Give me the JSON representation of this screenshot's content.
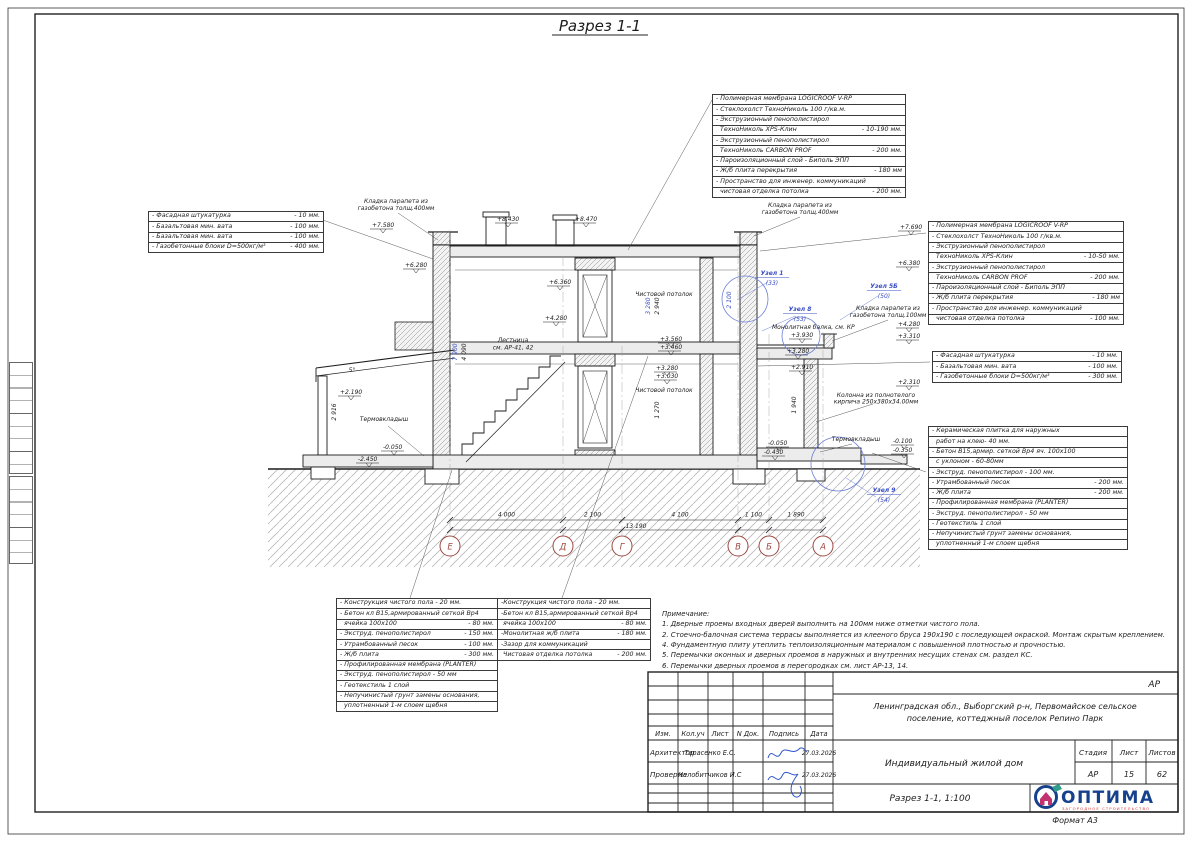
{
  "sheet": {
    "title": "Разрез 1-1",
    "format_label": "Формат А3"
  },
  "colors": {
    "line": "#1c1c1c",
    "blue_dim": "#3a4fc4",
    "axis_red": "#9c4a41",
    "logo_navy": "#16418c",
    "logo_red": "#d93a3a",
    "logo_teal": "#2e9e8a",
    "logo_magenta": "#c2326e"
  },
  "blocks": {
    "roof_top": {
      "lines": [
        {
          "t": "- Полимерная мембрана LOGICROOF V-RP",
          "v": ""
        },
        {
          "t": "- Стеклохолст ТехноНиколь 100 г/кв.м.",
          "v": ""
        },
        {
          "t": "- Экструзионный пенополистирол",
          "v": ""
        },
        {
          "t": "  ТехноНиколь XPS-Клин",
          "v": "- 10-190 мм."
        },
        {
          "t": "- Экструзионный пенополистирол",
          "v": ""
        },
        {
          "t": "  ТехноНиколь CARBON PROF",
          "v": "- 200 мм."
        },
        {
          "t": "- Пароизоляционный слой - Биполь ЭПП",
          "v": ""
        },
        {
          "t": "- Ж/б плита перекрытия",
          "v": "- 180 мм"
        },
        {
          "t": "- Пространство для инженер. коммуникаций",
          "v": ""
        },
        {
          "t": "  чистовая отделка потолка",
          "v": "- 200 мм."
        }
      ]
    },
    "roof_right": {
      "lines": [
        {
          "t": "- Полимерная мембрана LOGICROOF V-RP",
          "v": ""
        },
        {
          "t": "- Стеклохолст ТехноНиколь 100 г/кв.м.",
          "v": ""
        },
        {
          "t": "- Экструзионный пенополистирол",
          "v": ""
        },
        {
          "t": "  ТехноНиколь XPS-Клин",
          "v": "- 10-50 мм."
        },
        {
          "t": "- Экструзионный пенополистирол",
          "v": ""
        },
        {
          "t": "  ТехноНиколь CARBON PROF",
          "v": "- 200 мм."
        },
        {
          "t": "- Пароизоляционный слой - Биполь ЭПП",
          "v": ""
        },
        {
          "t": "- Ж/б плита перекрытия",
          "v": "- 180 мм"
        },
        {
          "t": "- Пространство для инженер. коммуникаций",
          "v": ""
        },
        {
          "t": "  чистовая отделка потолка",
          "v": "- 100 мм."
        }
      ]
    },
    "wall_left": {
      "lines": [
        {
          "t": "- Фасадная штукатурка",
          "v": "- 10 мм."
        },
        {
          "t": "- Базальтовая мин. вата",
          "v": "- 100 мм."
        },
        {
          "t": "- Базальтовая мин. вата",
          "v": "- 100 мм."
        },
        {
          "t": "- Газобетонные блоки D=500кг/м³",
          "v": "- 400 мм."
        }
      ]
    },
    "wall_right": {
      "lines": [
        {
          "t": "- Фасадная штукатурка",
          "v": "- 10 мм."
        },
        {
          "t": "- Базальтовая мин. вата",
          "v": "- 100 мм."
        },
        {
          "t": "- Газобетонные блоки D=500кг/м³",
          "v": "- 300 мм."
        }
      ]
    },
    "terrace_right": {
      "lines": [
        {
          "t": "- Керамическая плитка для наружных",
          "v": ""
        },
        {
          "t": "  работ на клею- 40 мм.",
          "v": ""
        },
        {
          "t": "- Бетон В15,армир. сеткой Вр4 яч. 100х100",
          "v": ""
        },
        {
          "t": "  с уклоном - 60-80мм",
          "v": ""
        },
        {
          "t": "- Экструд. пенополистирол - 100 мм.",
          "v": ""
        },
        {
          "t": "- Утрамбованный песок",
          "v": "- 200 мм."
        },
        {
          "t": "- Ж/б плита",
          "v": "- 200 мм."
        },
        {
          "t": "- Профилированная мембрана (PLANTER)",
          "v": ""
        },
        {
          "t": "- Экструд. пенополистирол - 50 мм",
          "v": ""
        },
        {
          "t": "- Геотекстиль 1 слой",
          "v": ""
        },
        {
          "t": "- Непучинистый грунт замены основания,",
          "v": ""
        },
        {
          "t": "  уплотненный 1-м слоем щебня",
          "v": ""
        }
      ]
    },
    "floor_ground": {
      "lines": [
        {
          "t": "- Конструкция чистого пола - 20 мм.",
          "v": ""
        },
        {
          "t": "- Бетон кл В15,армированный сеткой Вр4",
          "v": ""
        },
        {
          "t": "  ячейка 100х100",
          "v": "- 80 мм."
        },
        {
          "t": "- Экструд. пенополистирол",
          "v": "- 150 мм."
        },
        {
          "t": "- Утрамбованный песок",
          "v": "- 100 мм."
        },
        {
          "t": "- Ж/б плита",
          "v": "- 300 мм."
        },
        {
          "t": "- Профилированная мембрана (PLANTER)",
          "v": ""
        },
        {
          "t": "- Экструд. пенополистирол - 50 мм",
          "v": ""
        },
        {
          "t": "- Геотекстиль 1 слой",
          "v": ""
        },
        {
          "t": "- Непучинистый грунт замены основания,",
          "v": ""
        },
        {
          "t": "  уплотненный 1-м слоем щебня",
          "v": ""
        }
      ]
    },
    "floor_inter": {
      "lines": [
        {
          "t": "-Конструкция чистого пола - 20 мм.",
          "v": ""
        },
        {
          "t": "-Бетон кл В15,армированный сеткой Вр4",
          "v": ""
        },
        {
          "t": " ячейка 100х100",
          "v": "- 80 мм."
        },
        {
          "t": "-Монолитная ж/б плита",
          "v": "- 180 мм."
        },
        {
          "t": "-Зазор для коммуникаций",
          "v": ""
        },
        {
          "t": " Чистовая отделка потолка",
          "v": "- 200 мм."
        }
      ]
    }
  },
  "notes": {
    "title": "Примечание:",
    "items": [
      "1. Дверные проемы входных дверей выполнить на 100мм ниже отметки чистого пола.",
      "2. Стоечно-балочная система террасы выполняется из клееного бруса 190х190 с последующей окраской. Монтаж скрытым креплением.",
      "4. Фундаментную плиту утеплить теплоизоляционным материалом с повышенной плотностью и прочностью.",
      "5. Перемычки оконных и дверных проемов в наружных и внутренних несущих стенах см. раздел КС.",
      "6. Перемычки дверных проемов в перегородках см. лист АР-13, 14."
    ]
  },
  "drawing": {
    "elevations": [
      {
        "v": "+7.580",
        "x": 372,
        "y": 227
      },
      {
        "v": "+8.430",
        "x": 497,
        "y": 221
      },
      {
        "v": "+8.470",
        "x": 575,
        "y": 221
      },
      {
        "v": "+7.690",
        "x": 900,
        "y": 229
      },
      {
        "v": "+6.280",
        "x": 405,
        "y": 267
      },
      {
        "v": "+6.380",
        "x": 898,
        "y": 265
      },
      {
        "v": "+6.360",
        "x": 549,
        "y": 284
      },
      {
        "v": "+4.280",
        "x": 545,
        "y": 320
      },
      {
        "v": "+4.280",
        "x": 898,
        "y": 326
      },
      {
        "v": "+3.930",
        "x": 791,
        "y": 337
      },
      {
        "v": "+3.310",
        "x": 898,
        "y": 338
      },
      {
        "v": "+3.280",
        "x": 787,
        "y": 353
      },
      {
        "v": "+2.910",
        "x": 791,
        "y": 369
      },
      {
        "v": "+3.560",
        "x": 660,
        "y": 341
      },
      {
        "v": "+3.460",
        "x": 660,
        "y": 349
      },
      {
        "v": "+3.280",
        "x": 656,
        "y": 370
      },
      {
        "v": "+3.030",
        "x": 656,
        "y": 378
      },
      {
        "v": "+2.310",
        "x": 898,
        "y": 384
      },
      {
        "v": "+2.190",
        "x": 340,
        "y": 394
      },
      {
        "v": "-0.050",
        "x": 383,
        "y": 449
      },
      {
        "v": "-2.450",
        "x": 358,
        "y": 461
      },
      {
        "v": "-0.050",
        "x": 768,
        "y": 445
      },
      {
        "v": "-0.450",
        "x": 764,
        "y": 454
      },
      {
        "v": "-0.100",
        "x": 893,
        "y": 443
      },
      {
        "v": "-0.350",
        "x": 893,
        "y": 452
      }
    ],
    "dims_small": [
      {
        "v": "7 900",
        "x": 457,
        "y": 352,
        "b": true
      },
      {
        "v": "4 090",
        "x": 466,
        "y": 352
      },
      {
        "v": "2 916",
        "x": 336,
        "y": 412
      },
      {
        "v": "3 280",
        "x": 650,
        "y": 306,
        "b": true
      },
      {
        "v": "2 940",
        "x": 659,
        "y": 306
      },
      {
        "v": "2 100",
        "x": 731,
        "y": 300,
        "b": true
      },
      {
        "v": "1 270",
        "x": 659,
        "y": 410
      },
      {
        "v": "1 940",
        "x": 796,
        "y": 405
      }
    ],
    "labels": [
      {
        "t": "Кладка парапета из\nгазобетона толщ.400мм",
        "x": 396,
        "y": 203,
        "s": 5.5
      },
      {
        "t": "Кладка парапета из\nгазобетона толщ.400мм",
        "x": 800,
        "y": 207,
        "s": 5.5
      },
      {
        "t": "Кладка парапета из\nгазобетона толщ.100мм",
        "x": 888,
        "y": 310,
        "s": 5.5
      },
      {
        "t": "Монолитная балка, см. КР",
        "x": 772,
        "y": 329,
        "a": "start",
        "s": 5.5
      },
      {
        "t": "Лестница\nсм. АР-41, 42",
        "x": 513,
        "y": 342,
        "s": 6
      },
      {
        "t": "Чистовой потолок",
        "x": 664,
        "y": 296,
        "s": 6
      },
      {
        "t": "Чистовой потолок",
        "x": 664,
        "y": 392,
        "s": 6
      },
      {
        "t": "Термовкладыш",
        "x": 384,
        "y": 421,
        "s": 5.5
      },
      {
        "t": "Термовкладыш",
        "x": 856,
        "y": 441,
        "s": 5.5
      },
      {
        "t": "Колонна из полнотелого\nкирпича 250х380х34.00мм",
        "x": 876,
        "y": 397,
        "s": 5.2
      },
      {
        "t": "5°",
        "x": 352,
        "y": 372,
        "s": 6
      }
    ],
    "callouts": [
      {
        "t": "Узел 1",
        "n": "(33)",
        "x": 772,
        "y": 275
      },
      {
        "t": "Узел 8",
        "n": "(53)",
        "x": 800,
        "y": 311
      },
      {
        "t": "Узел 5Б",
        "n": "(50)",
        "x": 884,
        "y": 288
      },
      {
        "t": "Узел 9",
        "n": "(54)",
        "x": 884,
        "y": 492
      }
    ],
    "axes": [
      {
        "l": "Е",
        "x": 450,
        "t": 230
      },
      {
        "l": "Д",
        "x": 563,
        "t": 256
      },
      {
        "l": "Г",
        "x": 622,
        "t": 346
      },
      {
        "l": "В",
        "x": 738,
        "t": 236
      },
      {
        "l": "Б",
        "x": 769,
        "t": 334
      },
      {
        "l": "А",
        "x": 823,
        "t": 332
      }
    ],
    "dim_segments": [
      {
        "t": "4 000",
        "x1": 450,
        "x2": 563
      },
      {
        "t": "2 100",
        "x1": 563,
        "x2": 622
      },
      {
        "t": "4 100",
        "x1": 622,
        "x2": 738
      },
      {
        "t": "1 100",
        "x1": 738,
        "x2": 769
      },
      {
        "t": "1 890",
        "x1": 769,
        "x2": 823
      }
    ],
    "dim_total": {
      "t": "13 190",
      "x": 636,
      "y": 528
    }
  },
  "titleblock": {
    "doc_code": "АР",
    "location_line1": "Ленинградская обл., Выборгский р-н, Первомайское сельское",
    "location_line2": "поселение, коттеджный поселок Репино Парк",
    "cols": [
      "Изм.",
      "Кол.уч",
      "Лист",
      "N Док.",
      "Подпись",
      "Дата"
    ],
    "row1_role": "Архитектор",
    "row1_name": "Тарасенко Е.С.",
    "row1_date": "27.03.2026",
    "row2_role": "Проверил",
    "row2_name": "Челобитчиков И.С",
    "row2_date": "27.03.2026",
    "object_name": "Индивидуальный жилой дом",
    "stage_cols": [
      "Стадия",
      "Лист",
      "Листов"
    ],
    "stage_vals": [
      "АР",
      "15",
      "62"
    ],
    "drawing_name": "Разрез 1-1, 1:100"
  },
  "logo": {
    "name": "ОПТИМА",
    "subtitle": "ЗАГОРОДНОЕ СТРОИТЕЛЬСТВО"
  }
}
